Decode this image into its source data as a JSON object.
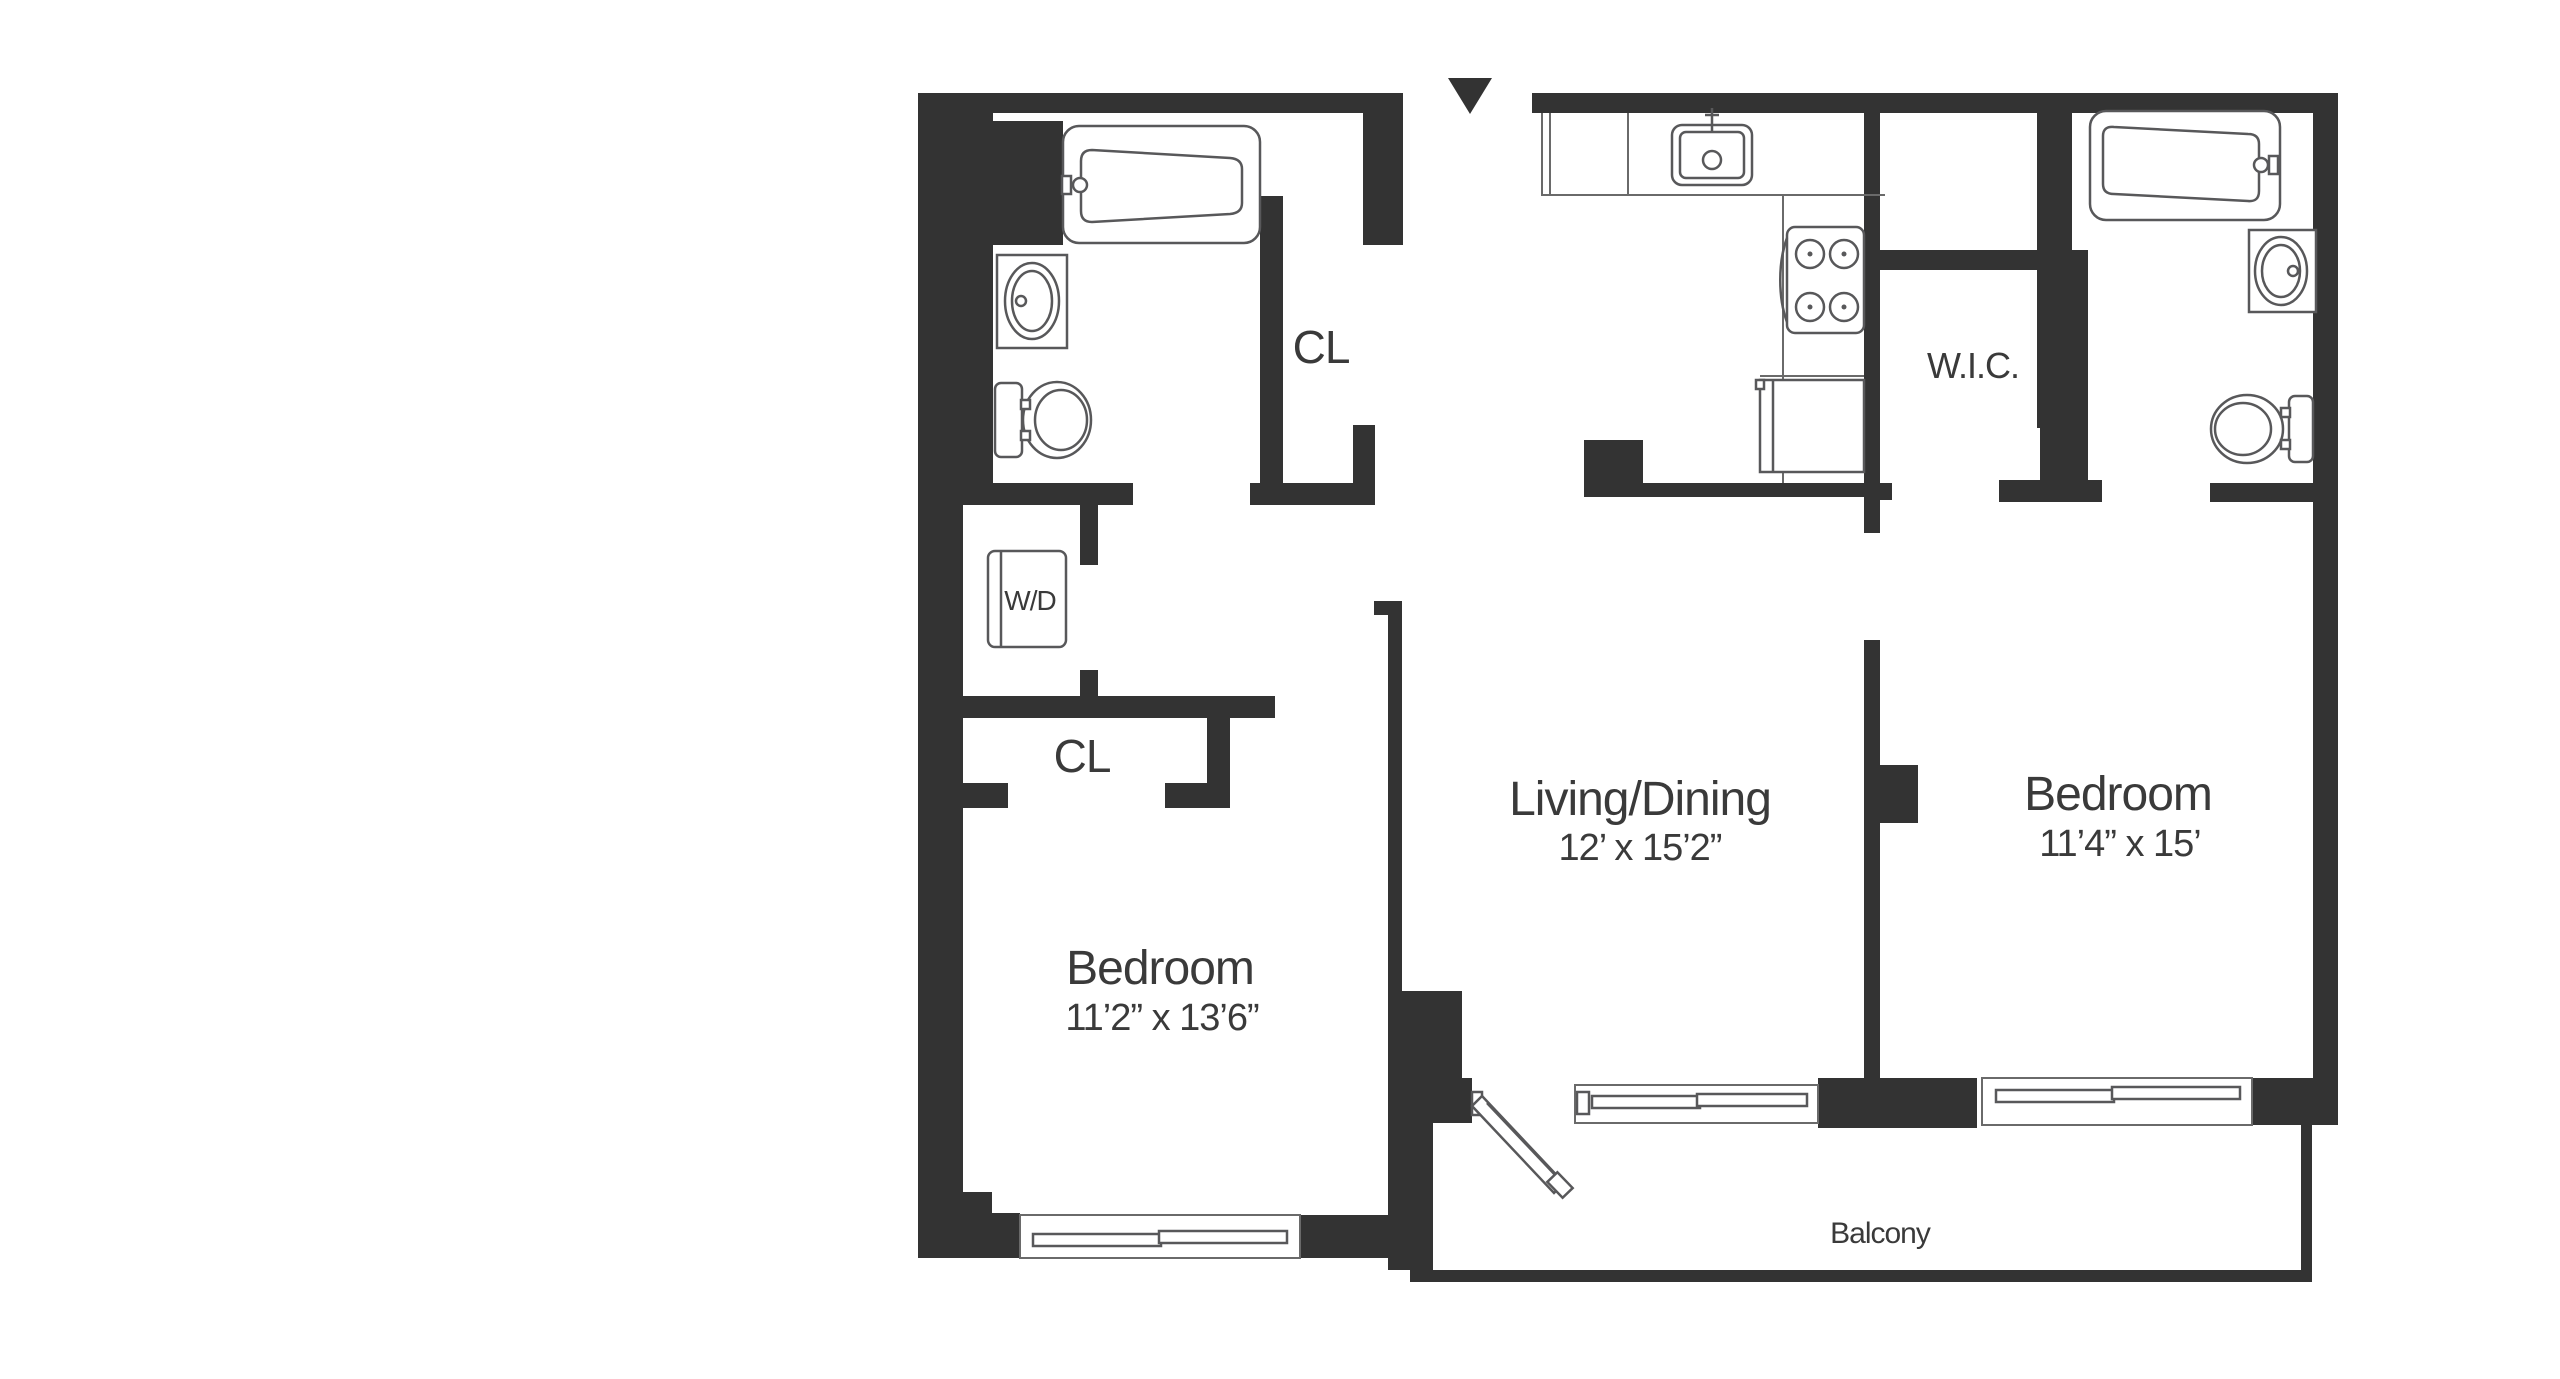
{
  "colors": {
    "wall": "#333333",
    "fixture_line": "#58585a",
    "text": "#3a3a3a",
    "background": "#ffffff"
  },
  "rooms": {
    "bedroom_left": {
      "name": "Bedroom",
      "dims": "11’2” x 13’6”"
    },
    "living_dining": {
      "name": "Living/Dining",
      "dims": "12’ x 15’2”"
    },
    "bedroom_right": {
      "name": "Bedroom",
      "dims": "11’4” x 15’"
    },
    "walk_in_closet": {
      "label": "W.I.C."
    },
    "closet_bath": {
      "label": "CL"
    },
    "closet_hall": {
      "label": "CL"
    },
    "washer_dryer": {
      "label": "W/D"
    },
    "balcony": {
      "label": "Balcony"
    }
  }
}
